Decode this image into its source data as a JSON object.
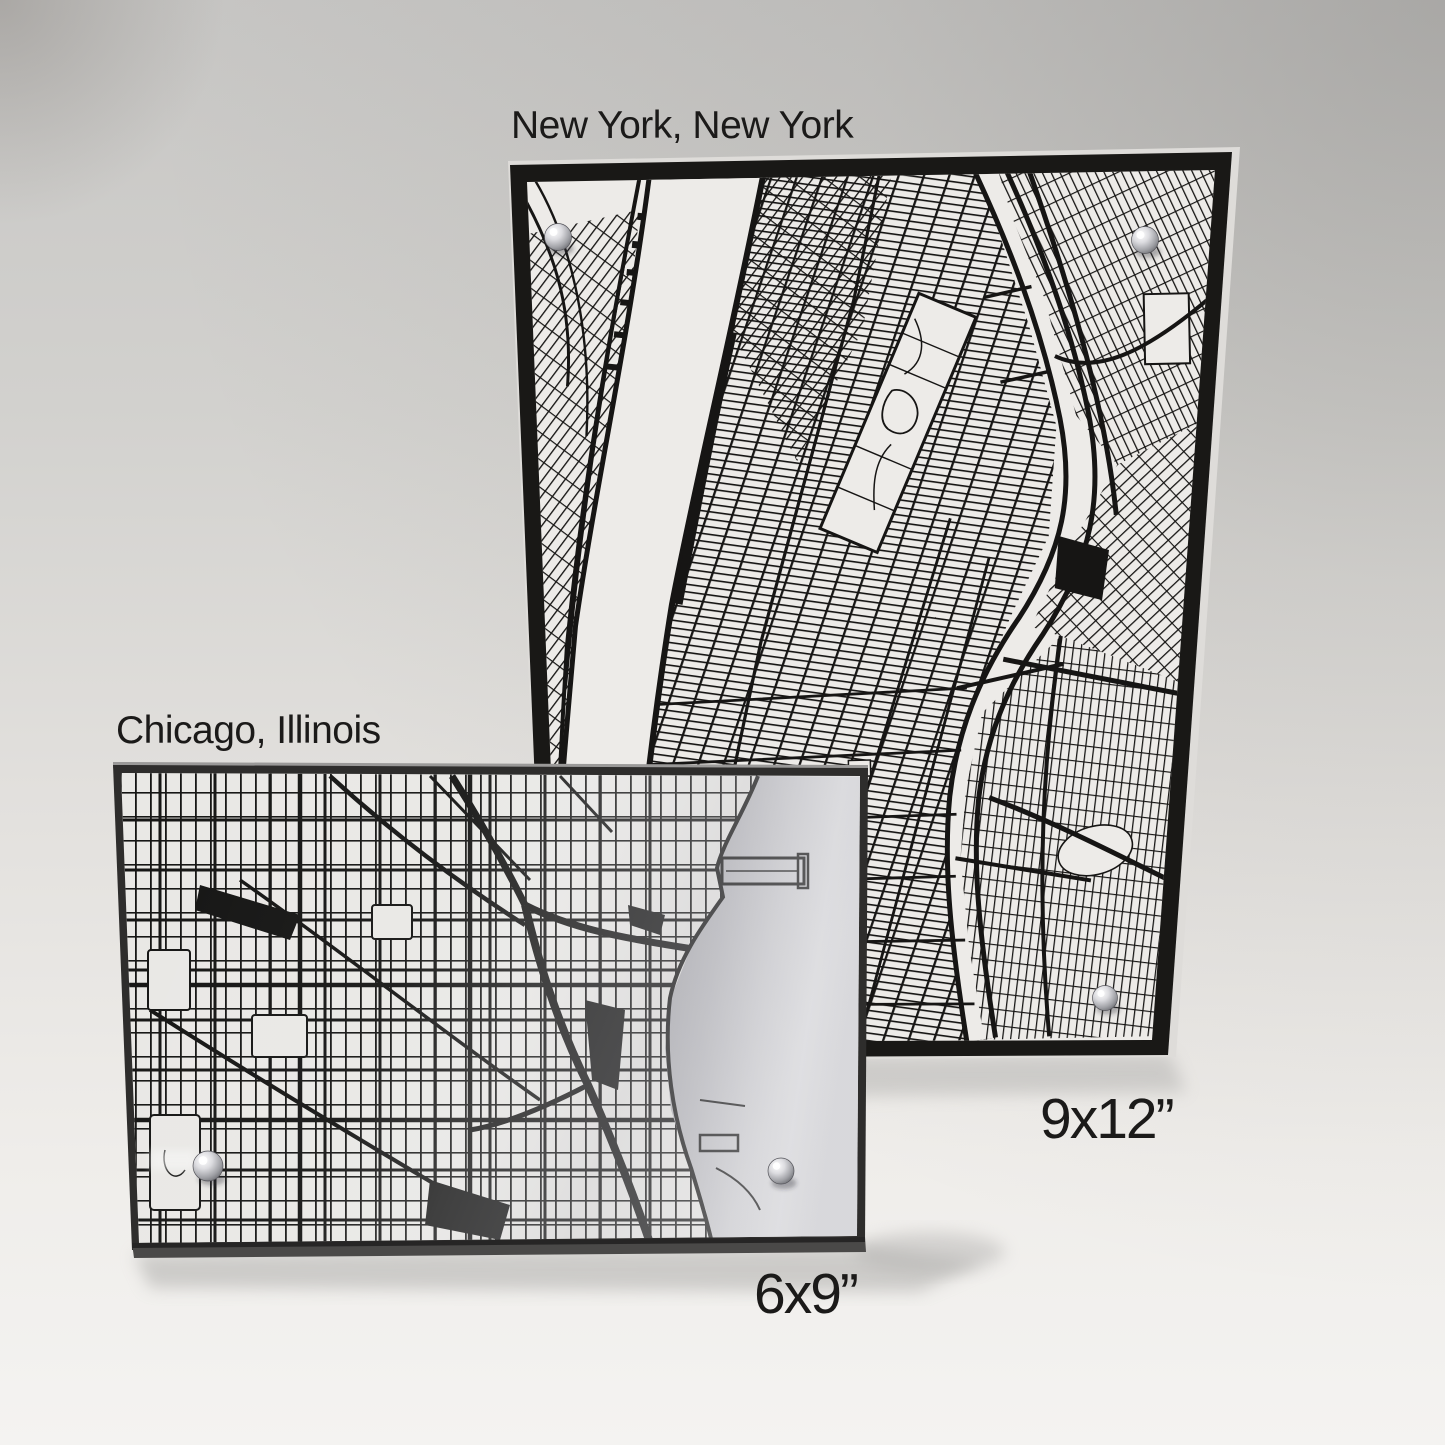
{
  "prints": {
    "new_york": {
      "city": "New York, New York",
      "size": "9x12”"
    },
    "chicago": {
      "city": "Chicago, Illinois",
      "size": "6x9”"
    }
  },
  "colors": {
    "backdrop_top": "#c7c6c4",
    "backdrop_bottom": "#f4f3f1",
    "frame_black": "#191816",
    "map_paper": "#edebe8",
    "street_ink": "#161514",
    "acrylic_silver": "#c3c3c7",
    "pin_steel": "#b9babf"
  }
}
